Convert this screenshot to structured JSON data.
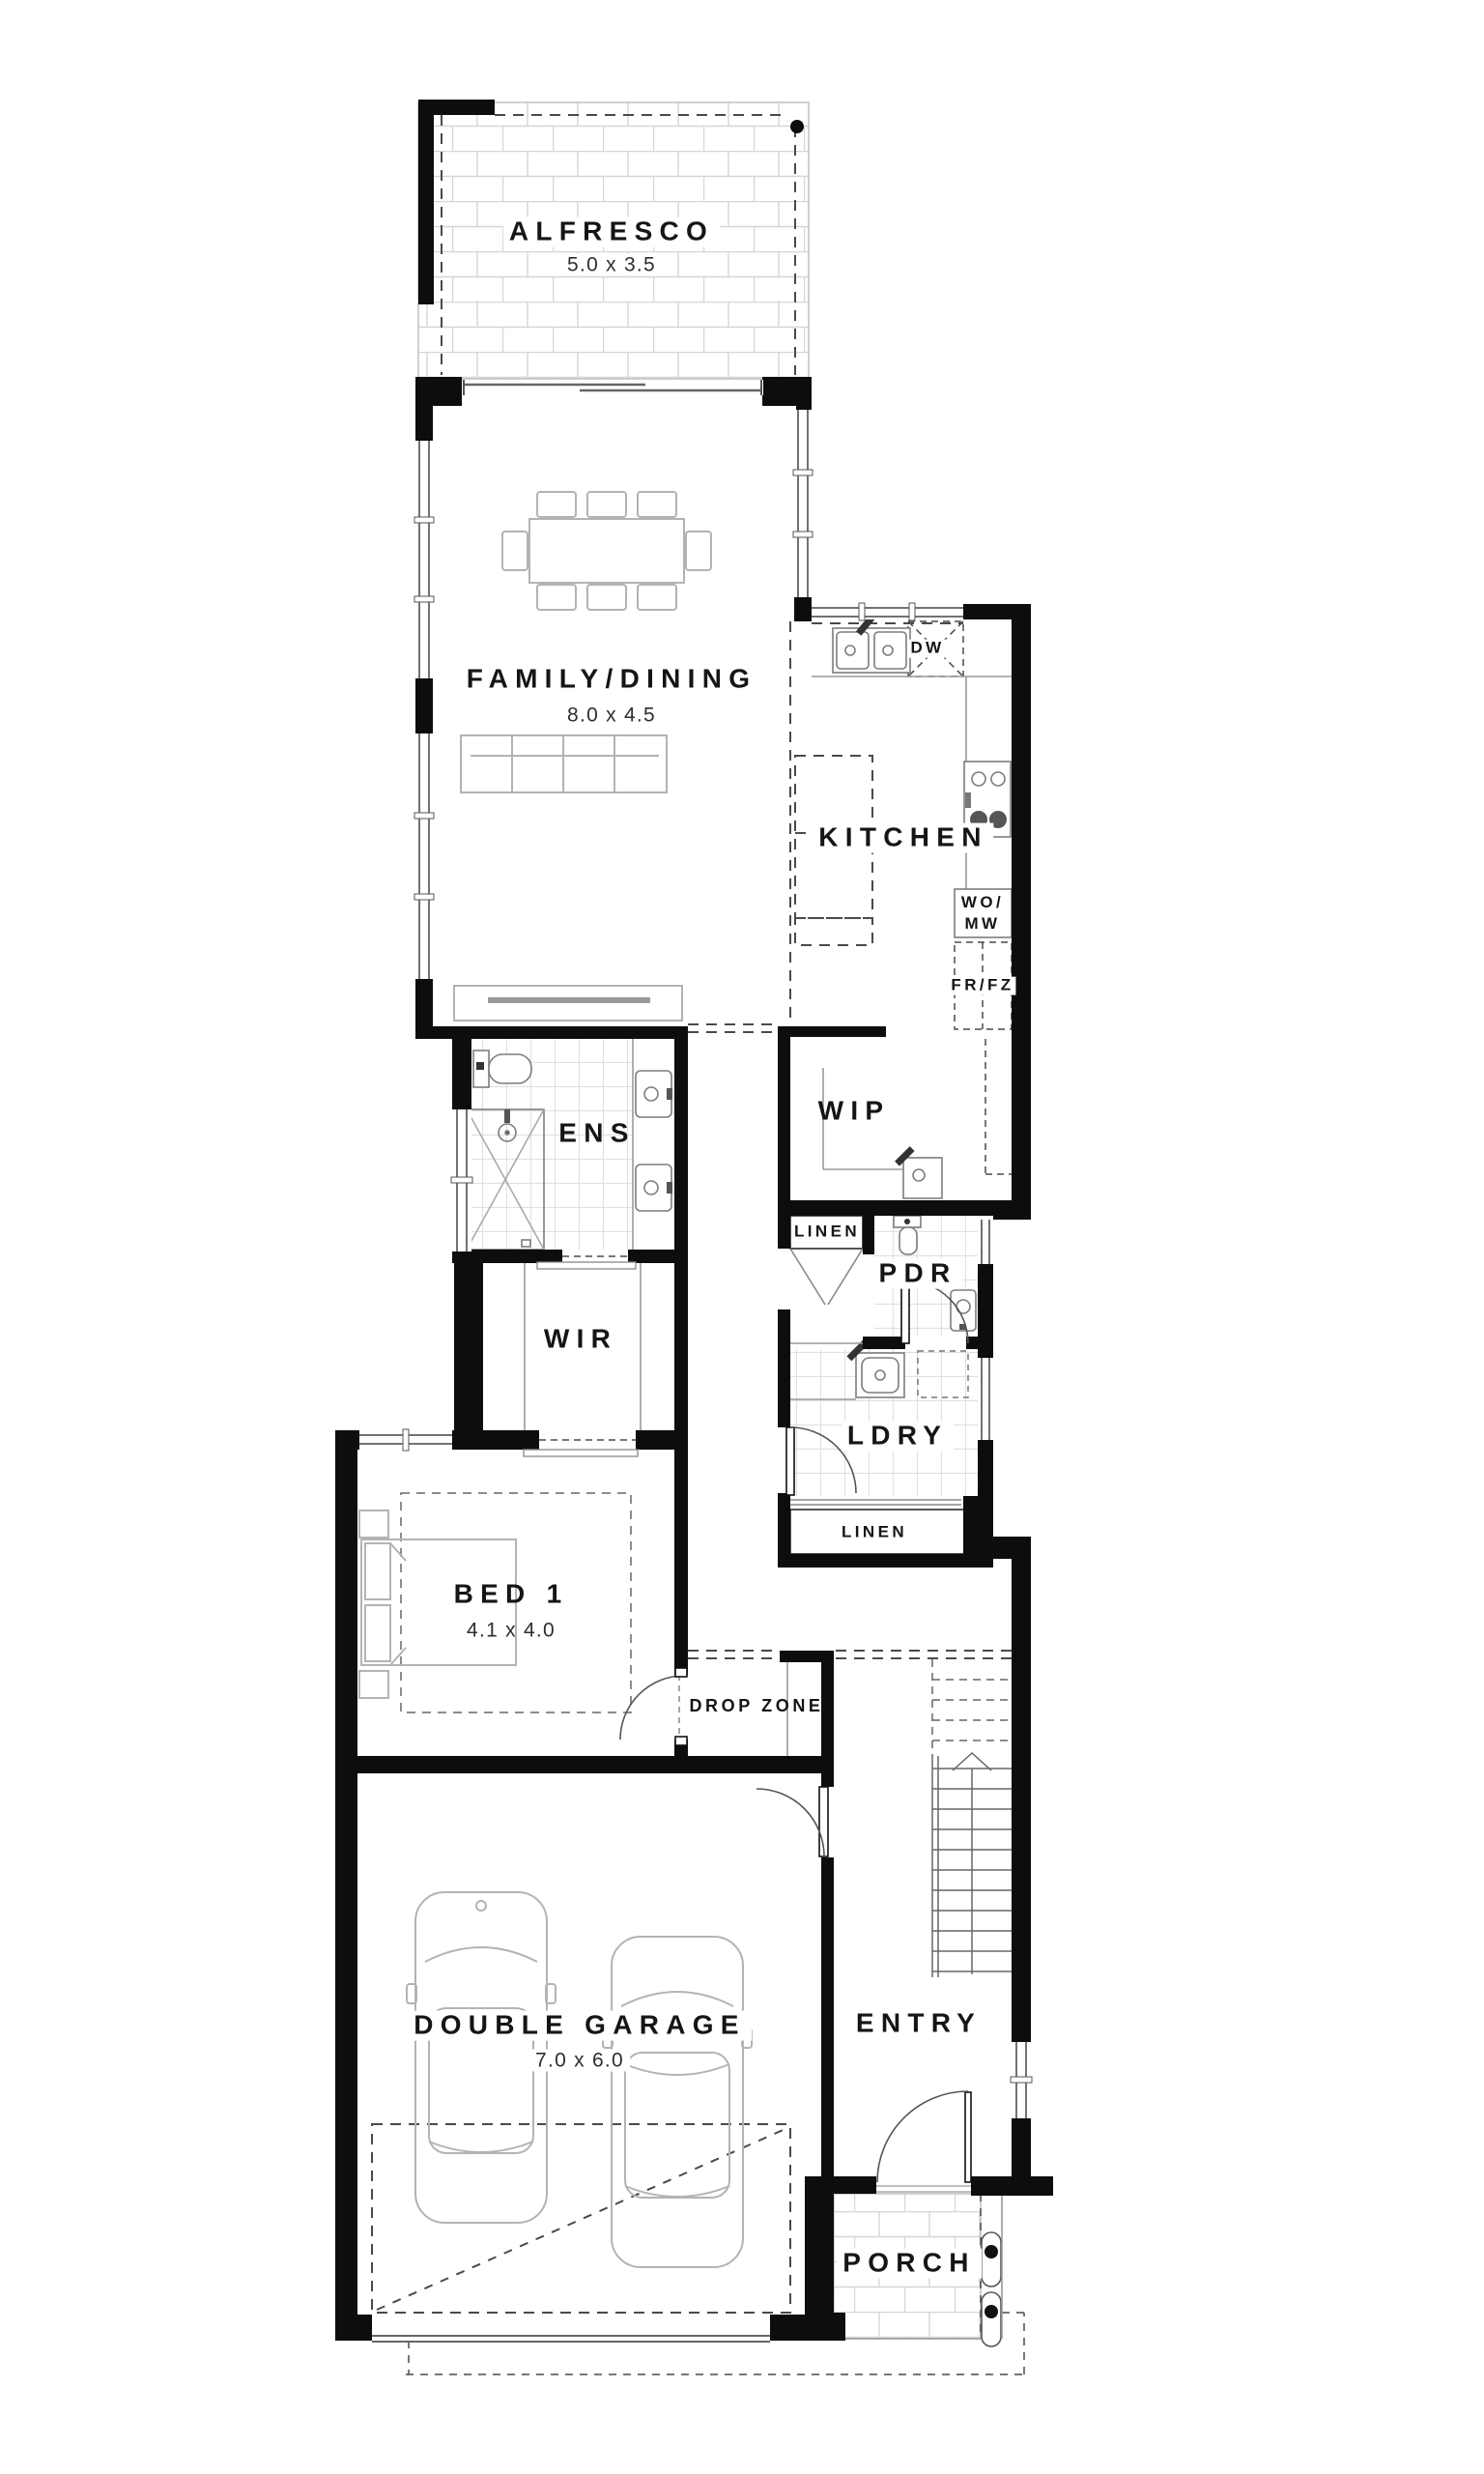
{
  "plan": {
    "type": "residential-floor-plan",
    "rooms": [
      {
        "id": "alfresco",
        "name": "ALFRESCO",
        "dims": "5.0 x 3.5"
      },
      {
        "id": "family-dining",
        "name": "FAMILY/DINING",
        "dims": "8.0 x 4.5"
      },
      {
        "id": "kitchen",
        "name": "KITCHEN",
        "dims": ""
      },
      {
        "id": "ens",
        "name": "ENS",
        "dims": ""
      },
      {
        "id": "wip",
        "name": "WIP",
        "dims": ""
      },
      {
        "id": "pdr",
        "name": "PDR",
        "dims": ""
      },
      {
        "id": "wir",
        "name": "WIR",
        "dims": ""
      },
      {
        "id": "ldry",
        "name": "LDRY",
        "dims": ""
      },
      {
        "id": "bed1",
        "name": "BED 1",
        "dims": "4.1 x 4.0"
      },
      {
        "id": "drop-zone",
        "name": "DROP ZONE",
        "dims": ""
      },
      {
        "id": "double-garage",
        "name": "DOUBLE GARAGE",
        "dims": "7.0 x 6.0"
      },
      {
        "id": "entry",
        "name": "ENTRY",
        "dims": ""
      },
      {
        "id": "porch",
        "name": "PORCH",
        "dims": ""
      }
    ],
    "closets": {
      "linen_upper": "LINEN",
      "linen_lower": "LINEN"
    },
    "appliances": {
      "dw": "DW",
      "wall_oven": [
        "WO/",
        "MW"
      ],
      "fridge": "FR/FZ"
    },
    "colors": {
      "wall": "#0d0d0d",
      "window": "#444444",
      "fixture": "#8a8a8a",
      "furniture": "#b3b3b3",
      "tile": "#e0e0e0",
      "brick": "#d6d6d6",
      "dash": "#4a4a4a",
      "text": "#151515"
    }
  }
}
